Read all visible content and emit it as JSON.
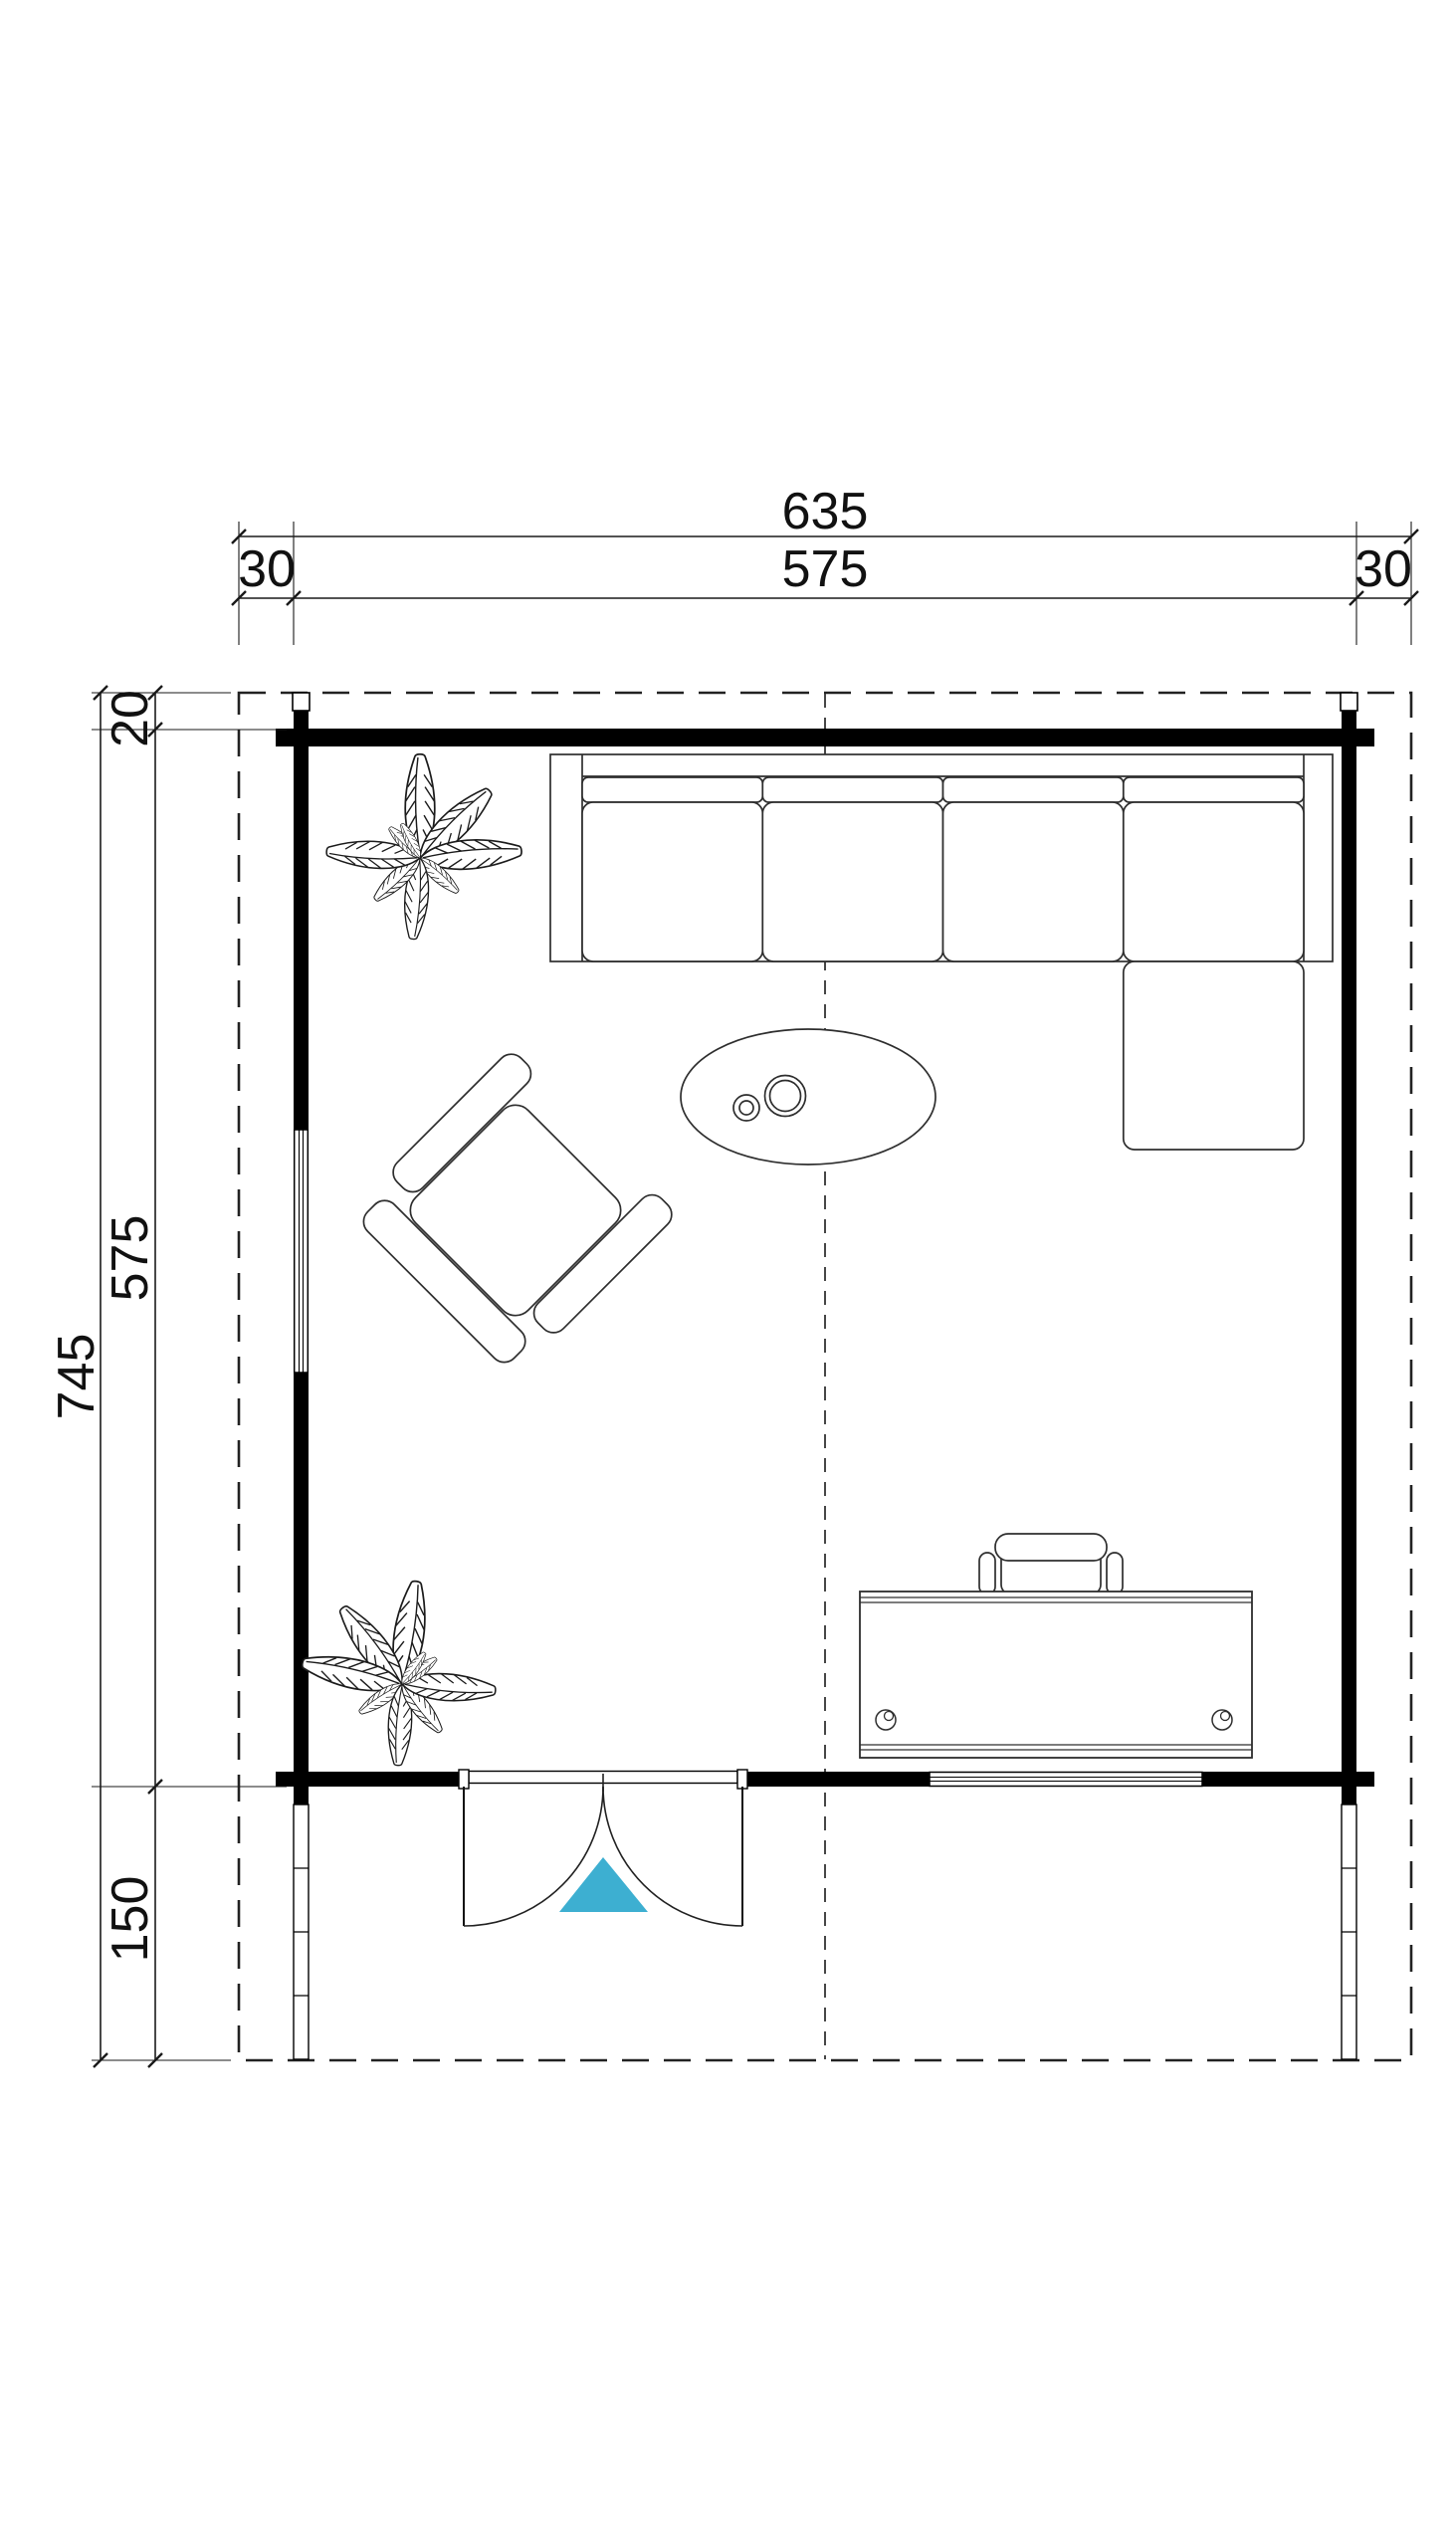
{
  "plan": {
    "title": "log-cabin-floor-plan",
    "accent_color": "#3DAFD1",
    "line_color": "#000000",
    "dims": {
      "top_total": "635",
      "top_left_overhang": "30",
      "top_width": "575",
      "top_right_overhang": "30",
      "left_top_overhang": "20",
      "left_depth": "575",
      "left_total": "745",
      "left_terrace": "150"
    },
    "furniture": [
      {
        "name": "corner-sofa"
      },
      {
        "name": "coffee-table"
      },
      {
        "name": "armchair"
      },
      {
        "name": "desk"
      },
      {
        "name": "office-chair"
      },
      {
        "name": "potted-plant-top"
      },
      {
        "name": "potted-plant-bottom"
      }
    ],
    "features": [
      {
        "name": "roof-overhang-outline"
      },
      {
        "name": "center-line"
      },
      {
        "name": "double-door"
      },
      {
        "name": "door-brand-triangle"
      },
      {
        "name": "window-left-wall"
      },
      {
        "name": "window-front-wall"
      },
      {
        "name": "terrace-side-left"
      },
      {
        "name": "terrace-side-right"
      }
    ]
  }
}
